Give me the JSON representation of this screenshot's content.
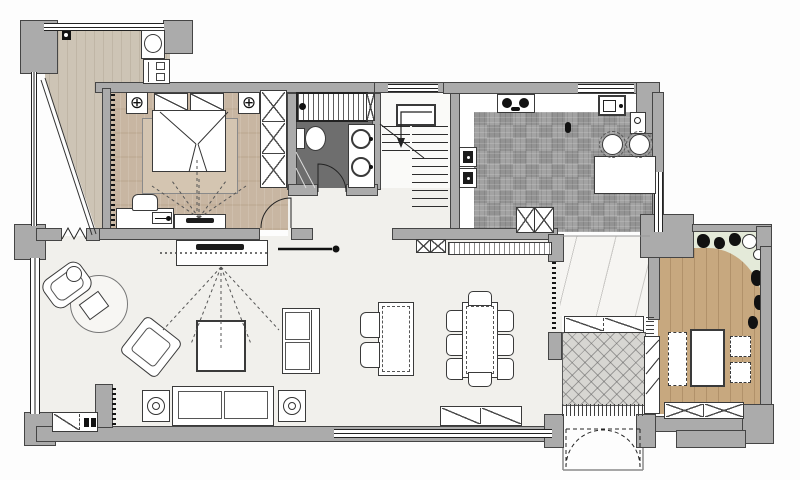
{
  "document": {
    "type": "architectural-floor-plan",
    "title": "Apartment floor plan — furnished layout"
  },
  "palette": {
    "wall": "#ababab",
    "line": "#454545",
    "white": "#ffffff",
    "woodBalcony": "#cdc4b5",
    "woodBedroom": "#c8b6a2",
    "woodStudy": "#c7a87f",
    "parquet": "#9b9b9b",
    "bathFloor": "#6e6e6e",
    "living": "#f1f0ec",
    "marble": "#f6f5f2",
    "hatchBase": "#d7d6d2",
    "garden": "#e4ead9",
    "rug": "#d4c5b1"
  },
  "icons": {
    "ceiling_lamp": "⊕"
  },
  "rooms": [
    {
      "id": "balcony",
      "name": "Balcony / laundry"
    },
    {
      "id": "master-bedroom",
      "name": "Master bedroom"
    },
    {
      "id": "bathroom",
      "name": "Bathroom"
    },
    {
      "id": "staircase",
      "name": "Staircase"
    },
    {
      "id": "kitchen",
      "name": "Kitchen"
    },
    {
      "id": "living-room",
      "name": "Living room"
    },
    {
      "id": "dining-room",
      "name": "Dining area"
    },
    {
      "id": "hallway",
      "name": "Marble hallway"
    },
    {
      "id": "entry-foyer",
      "name": "Entry foyer"
    },
    {
      "id": "study",
      "name": "Study / tea room"
    },
    {
      "id": "garden",
      "name": "Planting strip"
    }
  ],
  "furniture_inventory": {
    "balcony": [
      "wash basin",
      "storage cabinet"
    ],
    "master_bedroom": [
      "double bed",
      "two pillows",
      "area rug",
      "two ceiling lamps",
      "wardrobe",
      "desk with chair",
      "TV cabinet",
      "swing door"
    ],
    "bathroom": [
      "bathtub",
      "toilet",
      "double vanity sinks",
      "shower partition",
      "swing door"
    ],
    "staircase": [
      "two flights",
      "landing",
      "direction arrow"
    ],
    "kitchen": [
      "gas hob",
      "sink",
      "island counter",
      "two bar stools",
      "built-in appliances",
      "base cabinet"
    ],
    "living_room": [
      "round rug",
      "lounge chair with ottoman",
      "accent armchair",
      "square coffee table",
      "loveseat",
      "three-seat sofa",
      "two side tables with lamps",
      "TV console",
      "shoe cabinet",
      "bifold balcony door"
    ],
    "dining_room": [
      "console table with two chairs",
      "dining table with eight chairs",
      "sideboard"
    ],
    "entry_foyer": [
      "doormats",
      "double entry door",
      "shoe partition"
    ],
    "study": [
      "tea table",
      "bench",
      "two floor cushions",
      "window seat"
    ],
    "garden": [
      "planting bed",
      "two planter pots"
    ]
  }
}
